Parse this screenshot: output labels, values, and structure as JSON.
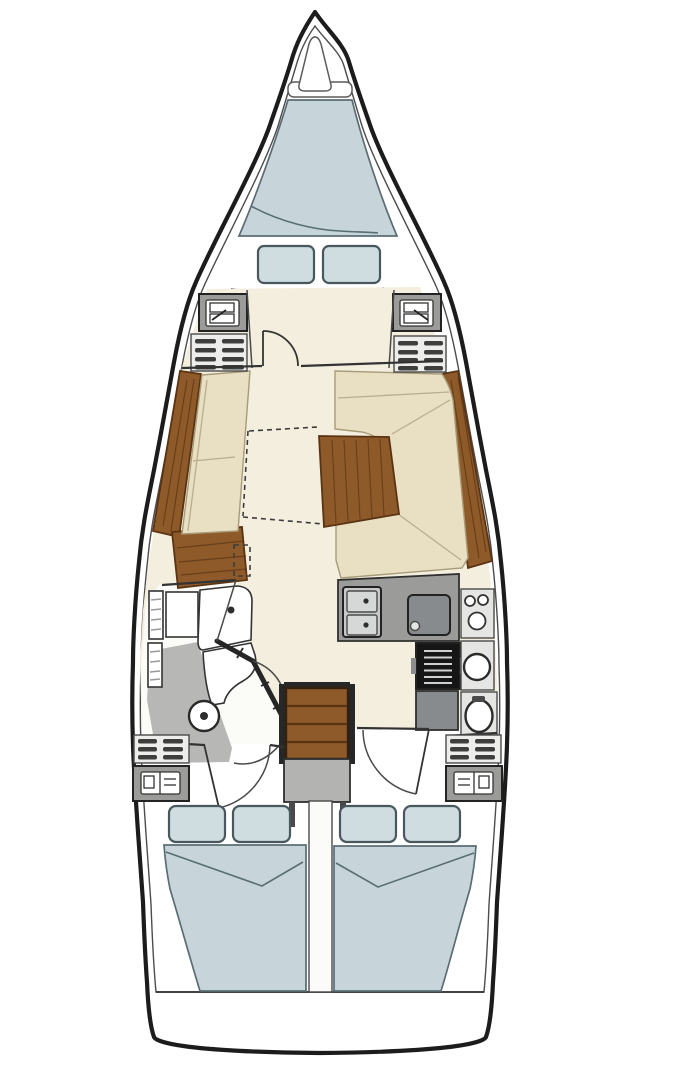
{
  "figure": {
    "kind": "sailboat-interior-floor-plan",
    "view": "top-down",
    "orientation": "bow-up",
    "regions": [
      "anchor-locker",
      "forward-cabin",
      "saloon",
      "galley",
      "head",
      "companionway",
      "aft-cabin-port",
      "aft-cabin-starboard",
      "transom"
    ]
  },
  "counts": {
    "forward_berth_pillows": 2,
    "aft_berth_pillows": 4,
    "companionway_steps": 4,
    "hob_burners": 2,
    "galley_sink_basins": 2,
    "deck_vent_panels": 4
  },
  "palette": {
    "background": "#ffffff",
    "hull_fill": "#ffffff",
    "hull_stroke": "#1c1c1c",
    "inner_line": "#4c4c4c",
    "floor_cream": "#f3eedd",
    "head_floor": "#fbfbf8",
    "cushion_beige": "#e9dfc2",
    "wood_brown": "#8f5a2a",
    "wood_edge": "#5a3312",
    "berth_blue": "#c7d5da",
    "pillow_blue": "#cfdce0",
    "counter_gray": "#9b9c9a",
    "sink_gray": "#c7c9c8",
    "basin_inner": "#d6d8d7",
    "appliance_gray": "#888b8d",
    "panel_light": "#e5e5e3",
    "vent_light": "#ededeb",
    "oven_black": "#161616",
    "tray_gray": "#b7b8b6",
    "landing_gray": "#b3b3b1",
    "locker_gray": "#9b9b99",
    "slat_dark": "#3e3e3c",
    "rail_dark": "#272727",
    "divider_white": "#fbfbfa",
    "fixture_white": "#ffffff",
    "hinge_dark": "#4a4a4a",
    "drain_dark": "#2e2e2e",
    "leg_gray": "#4a4a4a",
    "gimbal_gray": "#8d8d8d"
  }
}
